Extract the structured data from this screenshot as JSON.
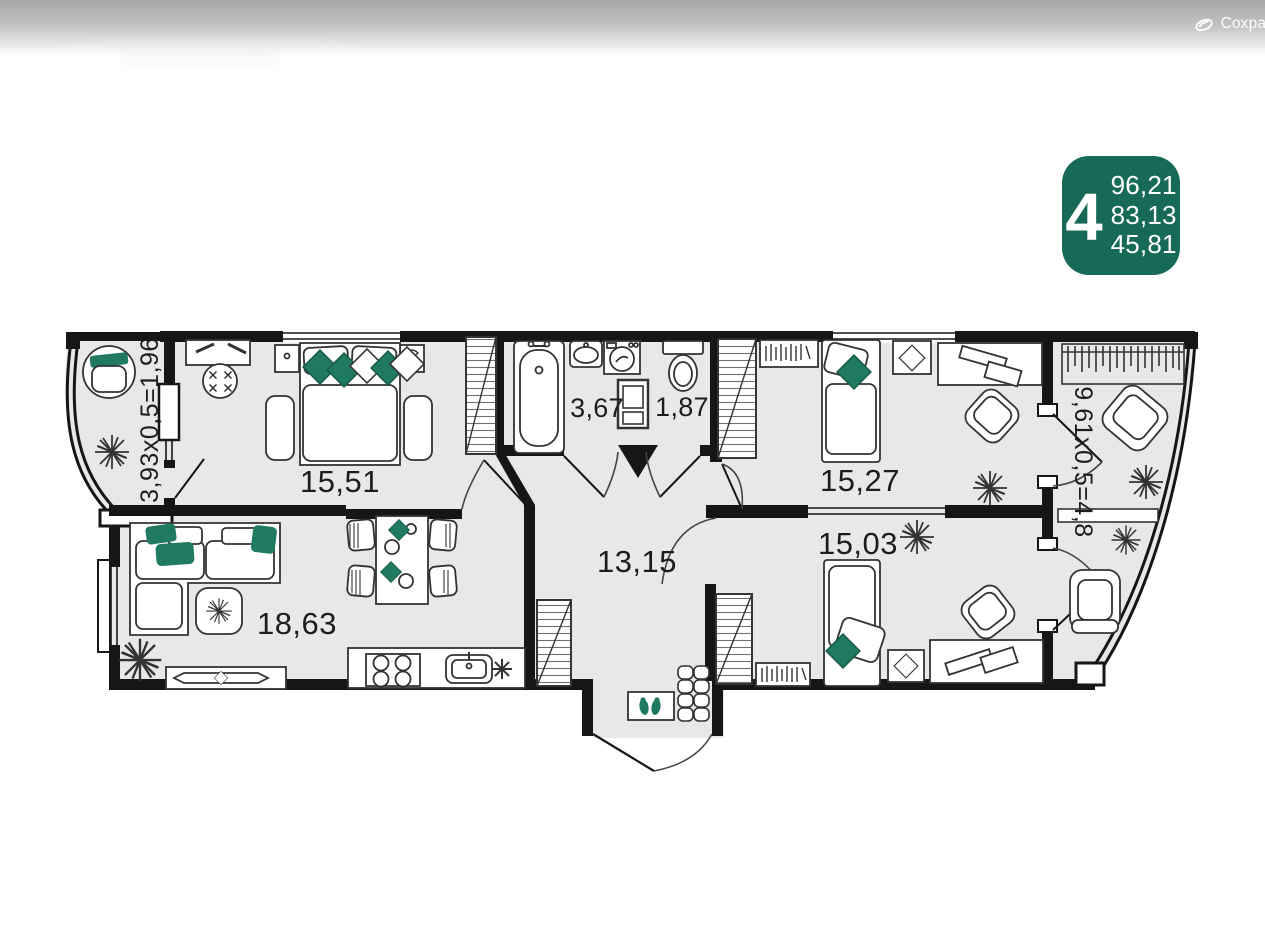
{
  "header": {
    "save_label": "Сохран"
  },
  "badge": {
    "rooms": "4",
    "color": "#176a57",
    "lines": [
      "96,21",
      "83,13",
      "45,81"
    ]
  },
  "floorplan": {
    "colors": {
      "floor": "#e9e8e6",
      "wall": "#161616",
      "accent": "#1f7a61"
    },
    "rooms": [
      {
        "id": "bedroom-1",
        "area": "15,51"
      },
      {
        "id": "bathroom",
        "area": "3,67"
      },
      {
        "id": "wc",
        "area": "1,87"
      },
      {
        "id": "bedroom-2",
        "area": "15,27"
      },
      {
        "id": "bedroom-3",
        "area": "15,03"
      },
      {
        "id": "hallway",
        "area": "13,15"
      },
      {
        "id": "living-kitchen",
        "area": "18,63"
      },
      {
        "id": "balcony-left",
        "area": "3,93x0,5=1,96"
      },
      {
        "id": "balcony-right",
        "area": "9,61x0,5=4,8"
      }
    ]
  }
}
